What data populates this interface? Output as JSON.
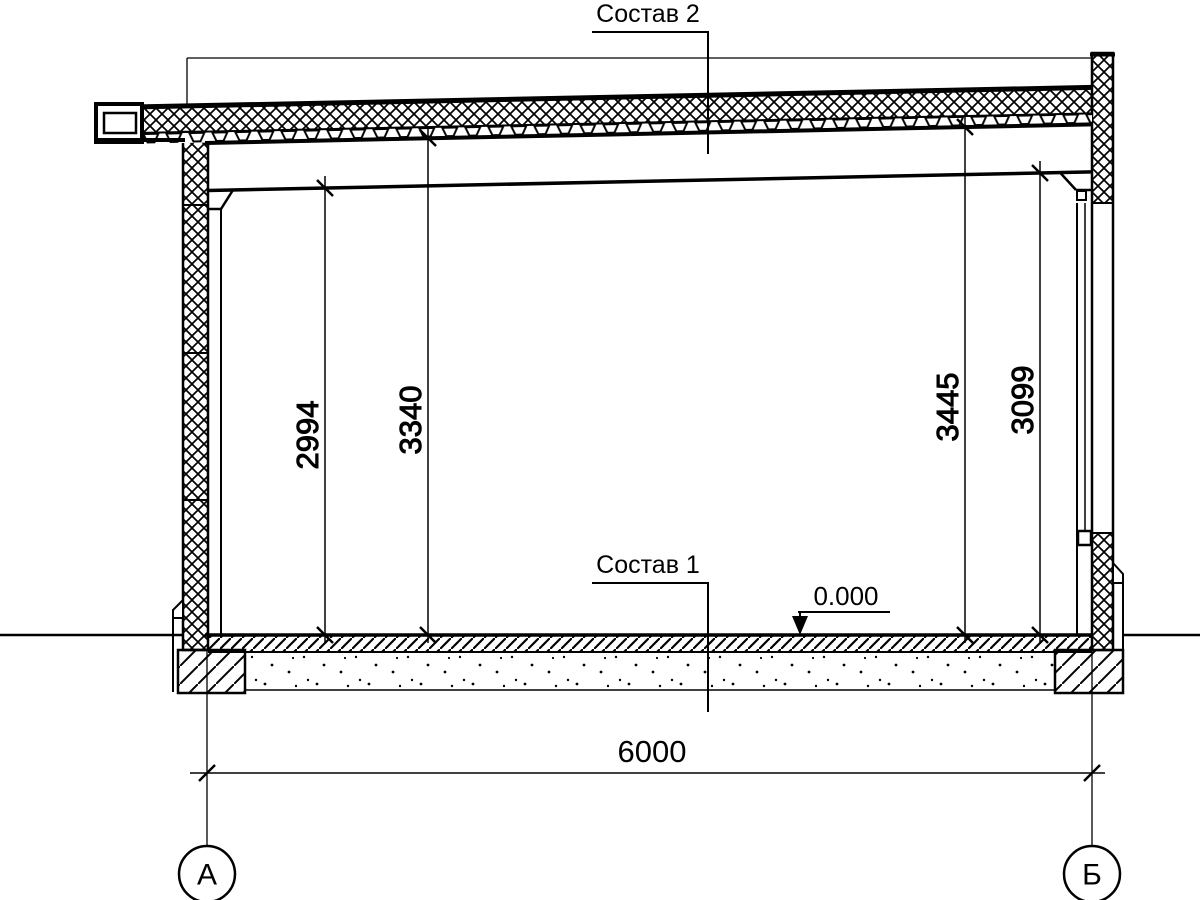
{
  "labels": {
    "roof_composition": "Состав 2",
    "floor_composition": "Состав 1"
  },
  "level_mark": "0.000",
  "dimensions": {
    "clear_height_left": "2994",
    "deck_height_left": "3340",
    "deck_height_right": "3445",
    "clear_height_right": "3099",
    "span": "6000"
  },
  "axis_markers": {
    "left": "А",
    "right": "Б"
  },
  "colors": {
    "line": "#000000",
    "background": "#ffffff"
  }
}
